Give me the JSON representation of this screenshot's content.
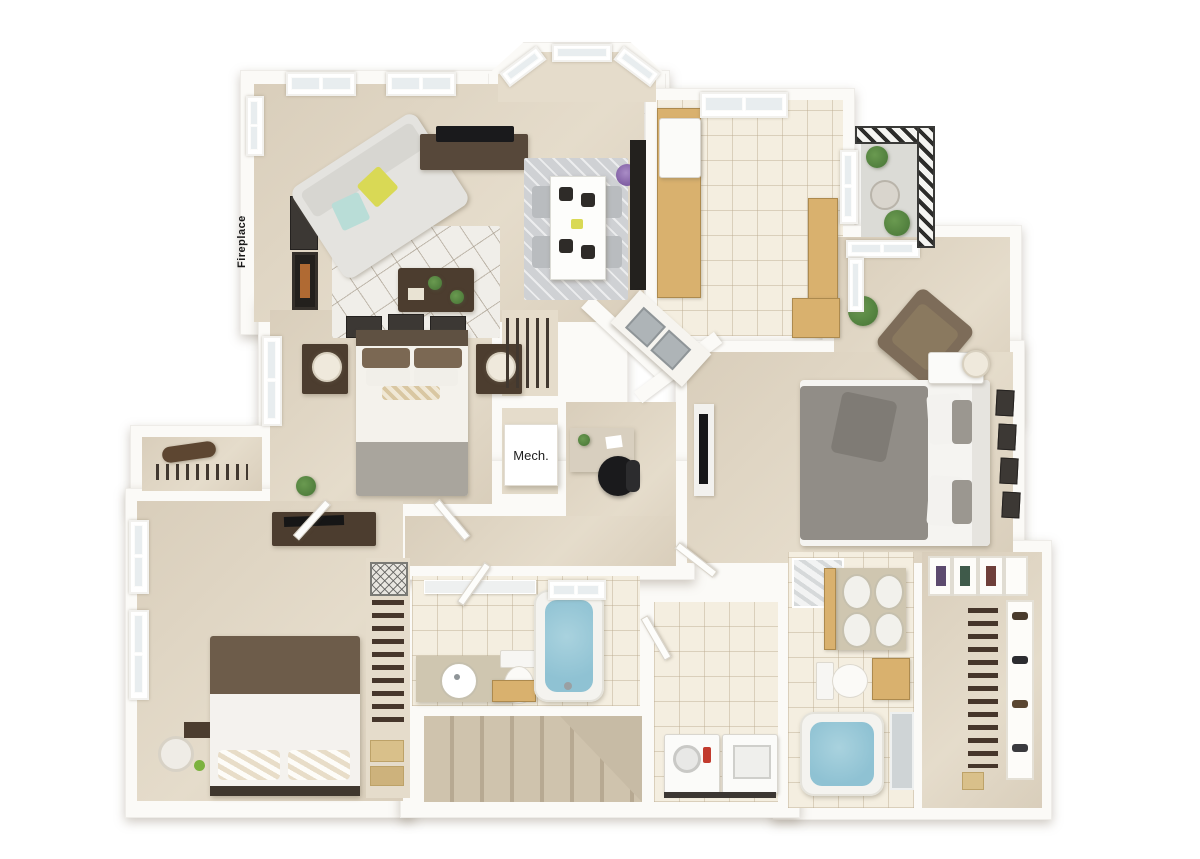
{
  "labels": {
    "fireplace": "Fireplace",
    "mech": "Mech."
  },
  "palette": {
    "wall": "#fbfaf7",
    "carpet": "#d9cebb",
    "carpet_light": "#e5dccb",
    "tile": "#f4eee0",
    "cabinet": "#d9b16e",
    "wood_dark": "#4c3d2f",
    "tub": "#8fc2d3",
    "sofa": "#e4e3df",
    "accent_yellow": "#d9d955",
    "accent_teal": "#b9ddd7",
    "chair_gray": "#b9bcbf",
    "bed_gray": "#918d87",
    "bed_brown": "#6d5c4a",
    "plant": "#4f7d3c",
    "black": "#1a1a1c"
  },
  "diagram_data": {
    "type": "floor-plan-3d-render",
    "view": "top-down 3D dollhouse",
    "rooms": [
      {
        "name": "Living Room",
        "features": [
          "fireplace with Fireplace label",
          "framed art",
          "sofa with yellow and teal pillows",
          "geometric area rug",
          "coffee table with plants",
          "tv console with tv",
          "two skylight windows"
        ]
      },
      {
        "name": "Dining Area",
        "features": [
          "bay window with three panes",
          "white table set for four",
          "four gray chairs",
          "gray rug",
          "purple plant",
          "dark hutch"
        ]
      },
      {
        "name": "Kitchen",
        "features": [
          "cream tile floor",
          "tan cabinets",
          "refrigerator",
          "angled double stainless sink",
          "tall pantry cabinet",
          "skylight",
          "window"
        ]
      },
      {
        "name": "Balcony",
        "features": [
          "dark metal railing",
          "round bistro table",
          "potted plants",
          "glass door"
        ]
      },
      {
        "name": "Master Suite",
        "features": [
          "sitting area with brown armchair and plant",
          "gray upholstered bed",
          "nightstand with lamp",
          "four picture frames on wall",
          "wall mounted tv"
        ]
      },
      {
        "name": "Master Bathroom",
        "features": [
          "glass shower",
          "double vanity with four basins",
          "toilet",
          "wood cabinet",
          "blue soaking tub"
        ]
      },
      {
        "name": "Walk-in Closet",
        "features": [
          "shelf unit",
          "hanging clothes",
          "shoe shelves",
          "storage box"
        ]
      },
      {
        "name": "Bedroom 2",
        "features": [
          "bed with brown pillows",
          "two nightstands with white lamps",
          "three picture frames",
          "window",
          "closet with hanging clothes"
        ]
      },
      {
        "name": "Bedroom 3",
        "features": [
          "bed with brown comforter and patterned pillows",
          "dresser with tv",
          "window",
          "hamper",
          "tall closet with clothes and folded linens"
        ]
      },
      {
        "name": "Bathroom 2",
        "features": [
          "vanity with round sink",
          "toilet",
          "wood cabinet",
          "blue bathtub",
          "tile floor"
        ]
      },
      {
        "name": "Laundry Closet",
        "features": [
          "washer",
          "dryer"
        ]
      },
      {
        "name": "Staircase",
        "features": [
          "carpeted steps with turn landing"
        ]
      },
      {
        "name": "Mechanical Closet",
        "features": [
          "white unit labeled Mech."
        ]
      },
      {
        "name": "Hallway",
        "features": [
          "coat closet",
          "linen shelves",
          "desk with black office chair",
          "open doors"
        ]
      }
    ]
  }
}
